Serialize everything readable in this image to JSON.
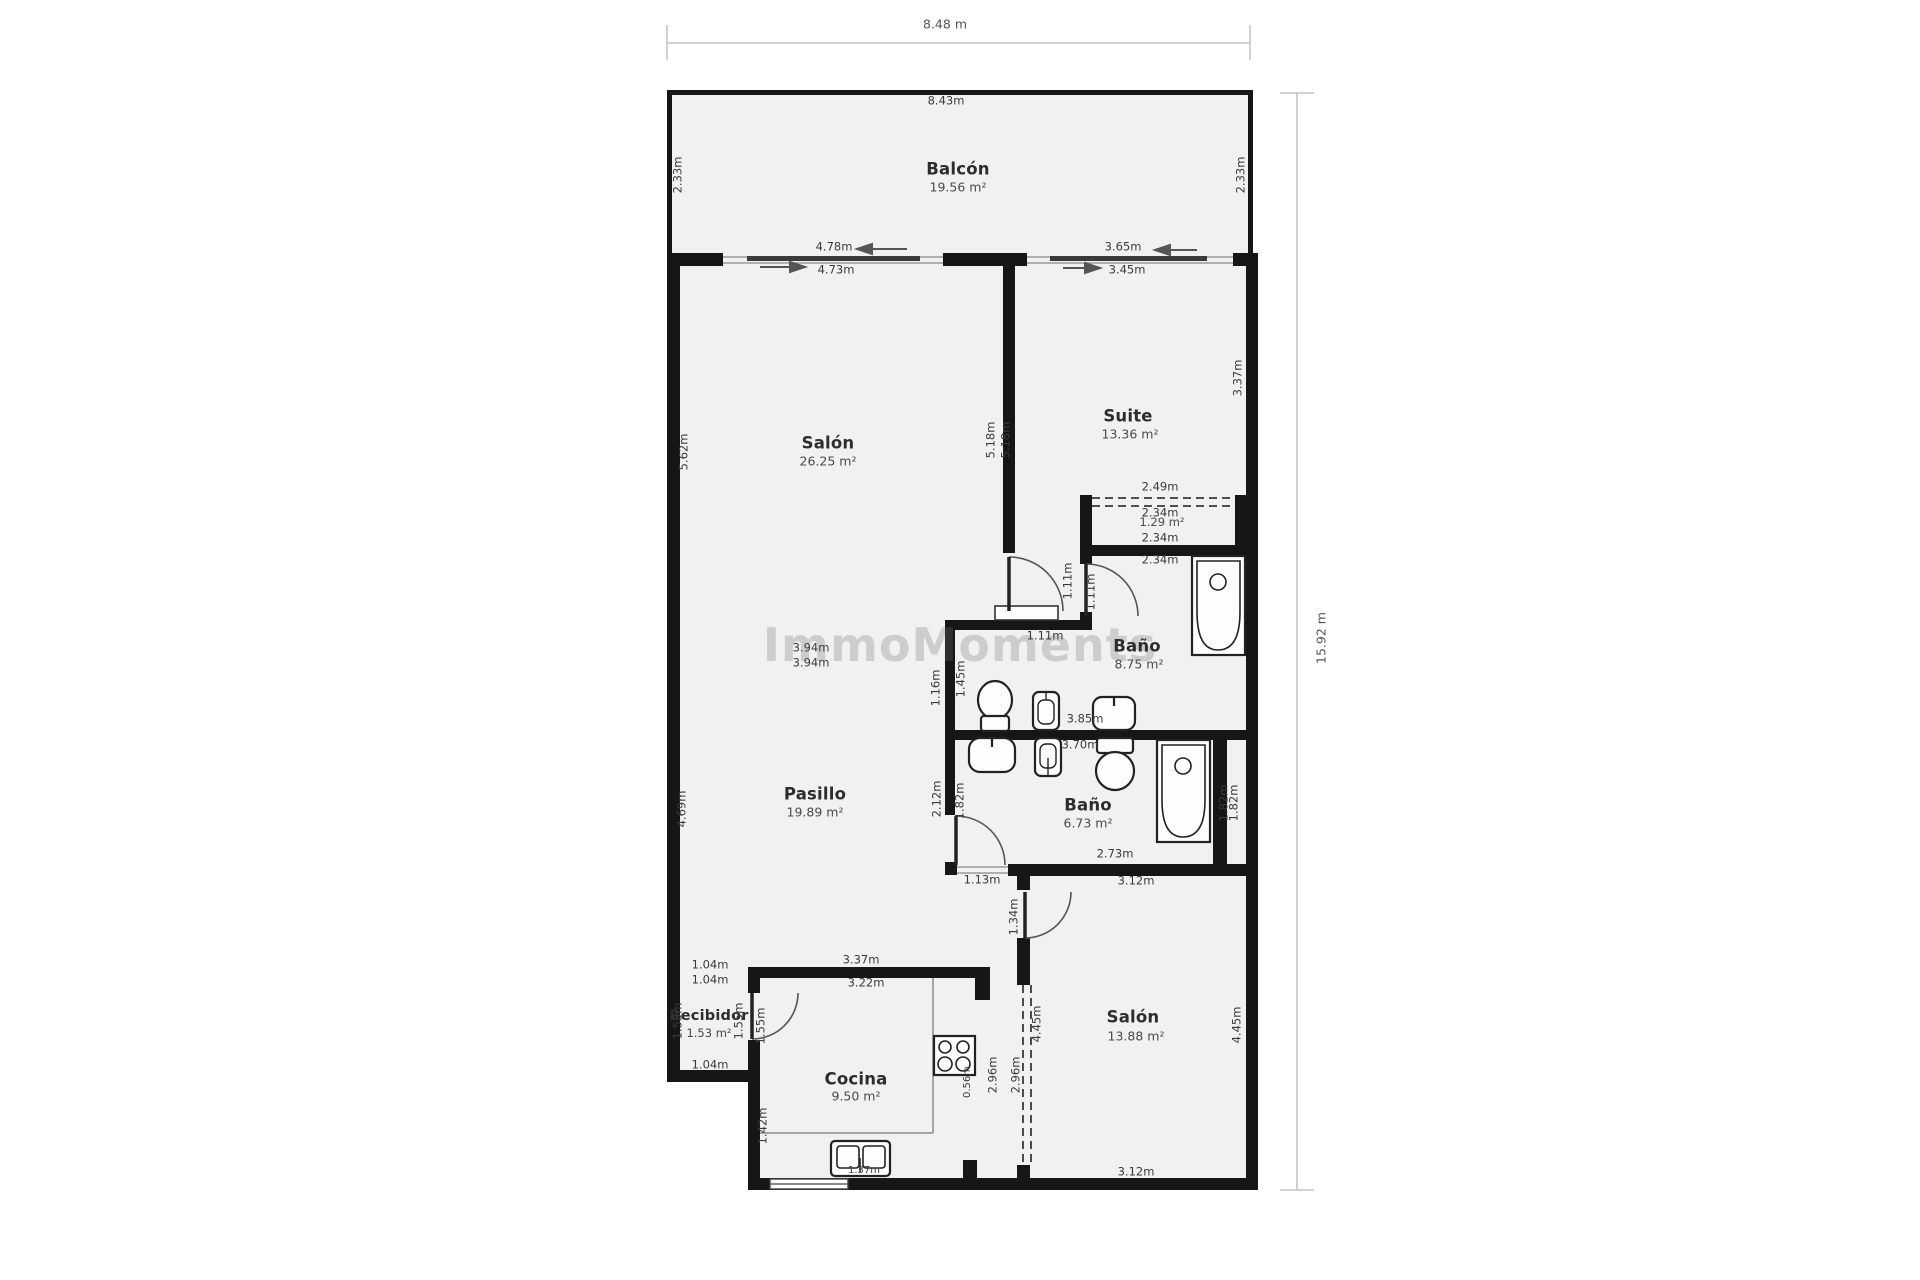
{
  "watermark": "ImmoMoments",
  "dims": {
    "width": "8.48 m",
    "height": "15.92 m"
  },
  "rooms": {
    "balcon": {
      "name": "Balcón",
      "area": "19.56 m²"
    },
    "salon": {
      "name": "Salón",
      "area": "26.25 m²"
    },
    "suite": {
      "name": "Suite",
      "area": "13.36 m²"
    },
    "armario": {
      "area": "1.29 m²"
    },
    "bano1": {
      "name": "Baño",
      "area": "8.75 m²"
    },
    "bano2": {
      "name": "Baño",
      "area": "6.73 m²"
    },
    "pasillo": {
      "name": "Pasillo",
      "area": "19.89 m²"
    },
    "salon2": {
      "name": "Salón",
      "area": "13.88 m²"
    },
    "cocina": {
      "name": "Cocina",
      "area": "9.50 m²"
    },
    "recibidor": {
      "name": "Recibidor",
      "area": "1.53 m²"
    }
  },
  "measures": {
    "m843": "8.43m",
    "v233L": "2.33m",
    "v233R": "2.33m",
    "m478": "4.78m",
    "m473": "4.73m",
    "m365": "3.65m",
    "m345": "3.45m",
    "v562": "5.62m",
    "v518a": "5.18m",
    "v518b": "5.18m",
    "v337s": "3.37m",
    "m394a": "3.94m",
    "m394b": "3.94m",
    "m249": "2.49m",
    "m234a": "2.34m",
    "m234b": "2.34m",
    "m234c": "2.34m",
    "v111a": "1.11m",
    "v111b": "1.11m",
    "m111c": "1.11m",
    "v145": "1.45m",
    "v116": "1.16m",
    "m385": "3.85m",
    "m370": "3.70m",
    "v469": "4.69m",
    "v212": "2.12m",
    "v182a": "1.82m",
    "v182b": "1.82m",
    "v182c": "1.82m",
    "m273": "2.73m",
    "m113": "1.13m",
    "m312a": "3.12m",
    "m312b": "3.12m",
    "v134": "1.34m",
    "v445a": "4.45m",
    "v445b": "4.45m",
    "v296a": "2.96m",
    "v296b": "2.96m",
    "m104a": "1.04m",
    "m104b": "1.04m",
    "m104c": "1.04m",
    "m337": "3.37m",
    "m322": "3.22m",
    "v155a": "1.55m",
    "v155b": "1.55m",
    "v155c": "1.55m",
    "v056": "0.56m",
    "v142": "1.42m",
    "m137": "1.37m"
  },
  "colors": {
    "wall": "#161616",
    "room_fill": "#f1f1f1",
    "label_text": "#3b3b3b"
  }
}
